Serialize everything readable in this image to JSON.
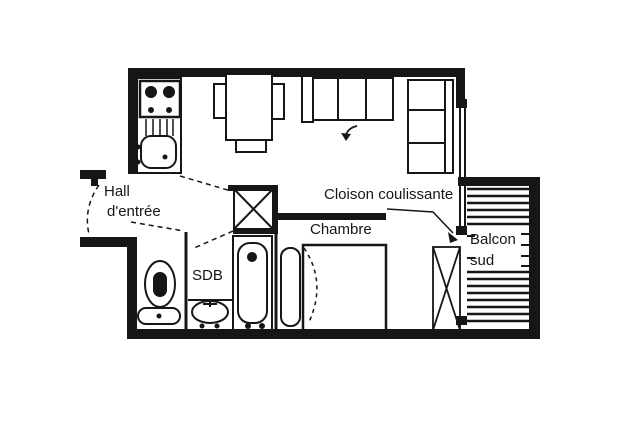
{
  "colors": {
    "ink": "#161616",
    "paper": "#ffffff"
  },
  "plan": {
    "rooms": {
      "hall": {
        "line1": "Hall",
        "line2": "d'entrée"
      },
      "chambre": {
        "label": "Chambre"
      },
      "sdb": {
        "label": "SDB"
      },
      "balcon": {
        "line1": "Balcon",
        "line2": "sud"
      }
    },
    "annotations": {
      "cloison": {
        "label": "Cloison coulissante"
      }
    }
  }
}
